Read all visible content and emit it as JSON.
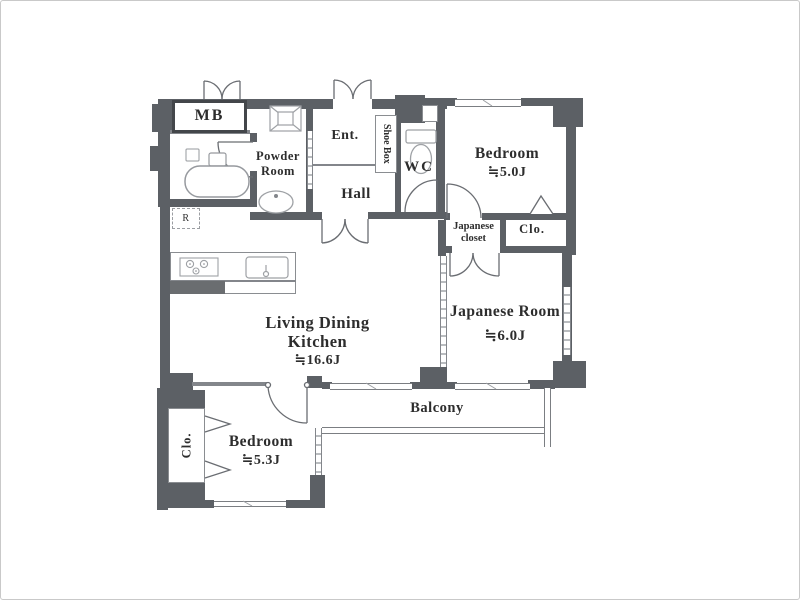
{
  "plan": {
    "title": "apartment-floor-plan",
    "rooms": {
      "mb": "MB",
      "powder_line1": "Powder",
      "powder_line2": "Room",
      "entrance": "Ent.",
      "shoe_box": "Shoe Box",
      "wc": "WC",
      "hall": "Hall",
      "bedroom_upper_name": "Bedroom",
      "bedroom_upper_area": "≒5.0J",
      "japanese_closet_line1": "Japanese",
      "japanese_closet_line2": "closet",
      "closet_upper": "Clo.",
      "japanese_room_name": "Japanese Room",
      "japanese_room_area": "≒6.0J",
      "ldk_line1": "Living Dining",
      "ldk_line2": "Kitchen",
      "ldk_area": "≒16.6J",
      "balcony": "Balcony",
      "bedroom_lower_name": "Bedroom",
      "bedroom_lower_area": "≒5.3J",
      "closet_lower": "Clo.",
      "refrigerator": "R"
    },
    "colors": {
      "wall": "#5c6065",
      "wall_light": "#83868b",
      "fixture_stroke": "#8d9095",
      "door_stroke": "#6a6d72",
      "text": "#2d2d2d",
      "background": "#ffffff",
      "frame_border": "#c9c9c9"
    }
  }
}
